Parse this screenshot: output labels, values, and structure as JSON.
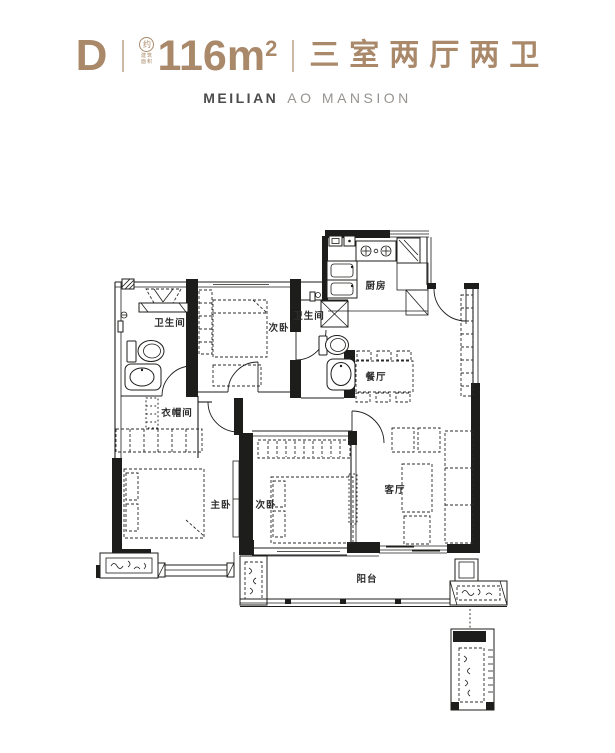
{
  "header": {
    "unit": "D",
    "area_icon_text": "约",
    "area_icon_caption": "建筑面积",
    "area_value": "116m",
    "area_sup": "2",
    "layout_desc": "三室两厅两卫",
    "brand_primary": "MEILIAN",
    "brand_secondary": "AO MANSION",
    "accent_color": "#a9896a"
  },
  "floorplan": {
    "wall_color": "#1d1d1b",
    "rooms": {
      "bathroom1": "卫生间",
      "bedroom1": "次卧",
      "bathroom2": "卫生间",
      "kitchen": "厨房",
      "dining": "餐厅",
      "cloakroom": "衣帽间",
      "master_bedroom": "主卧",
      "bedroom2": "次卧",
      "living": "客厅",
      "balcony": "阳台"
    }
  }
}
